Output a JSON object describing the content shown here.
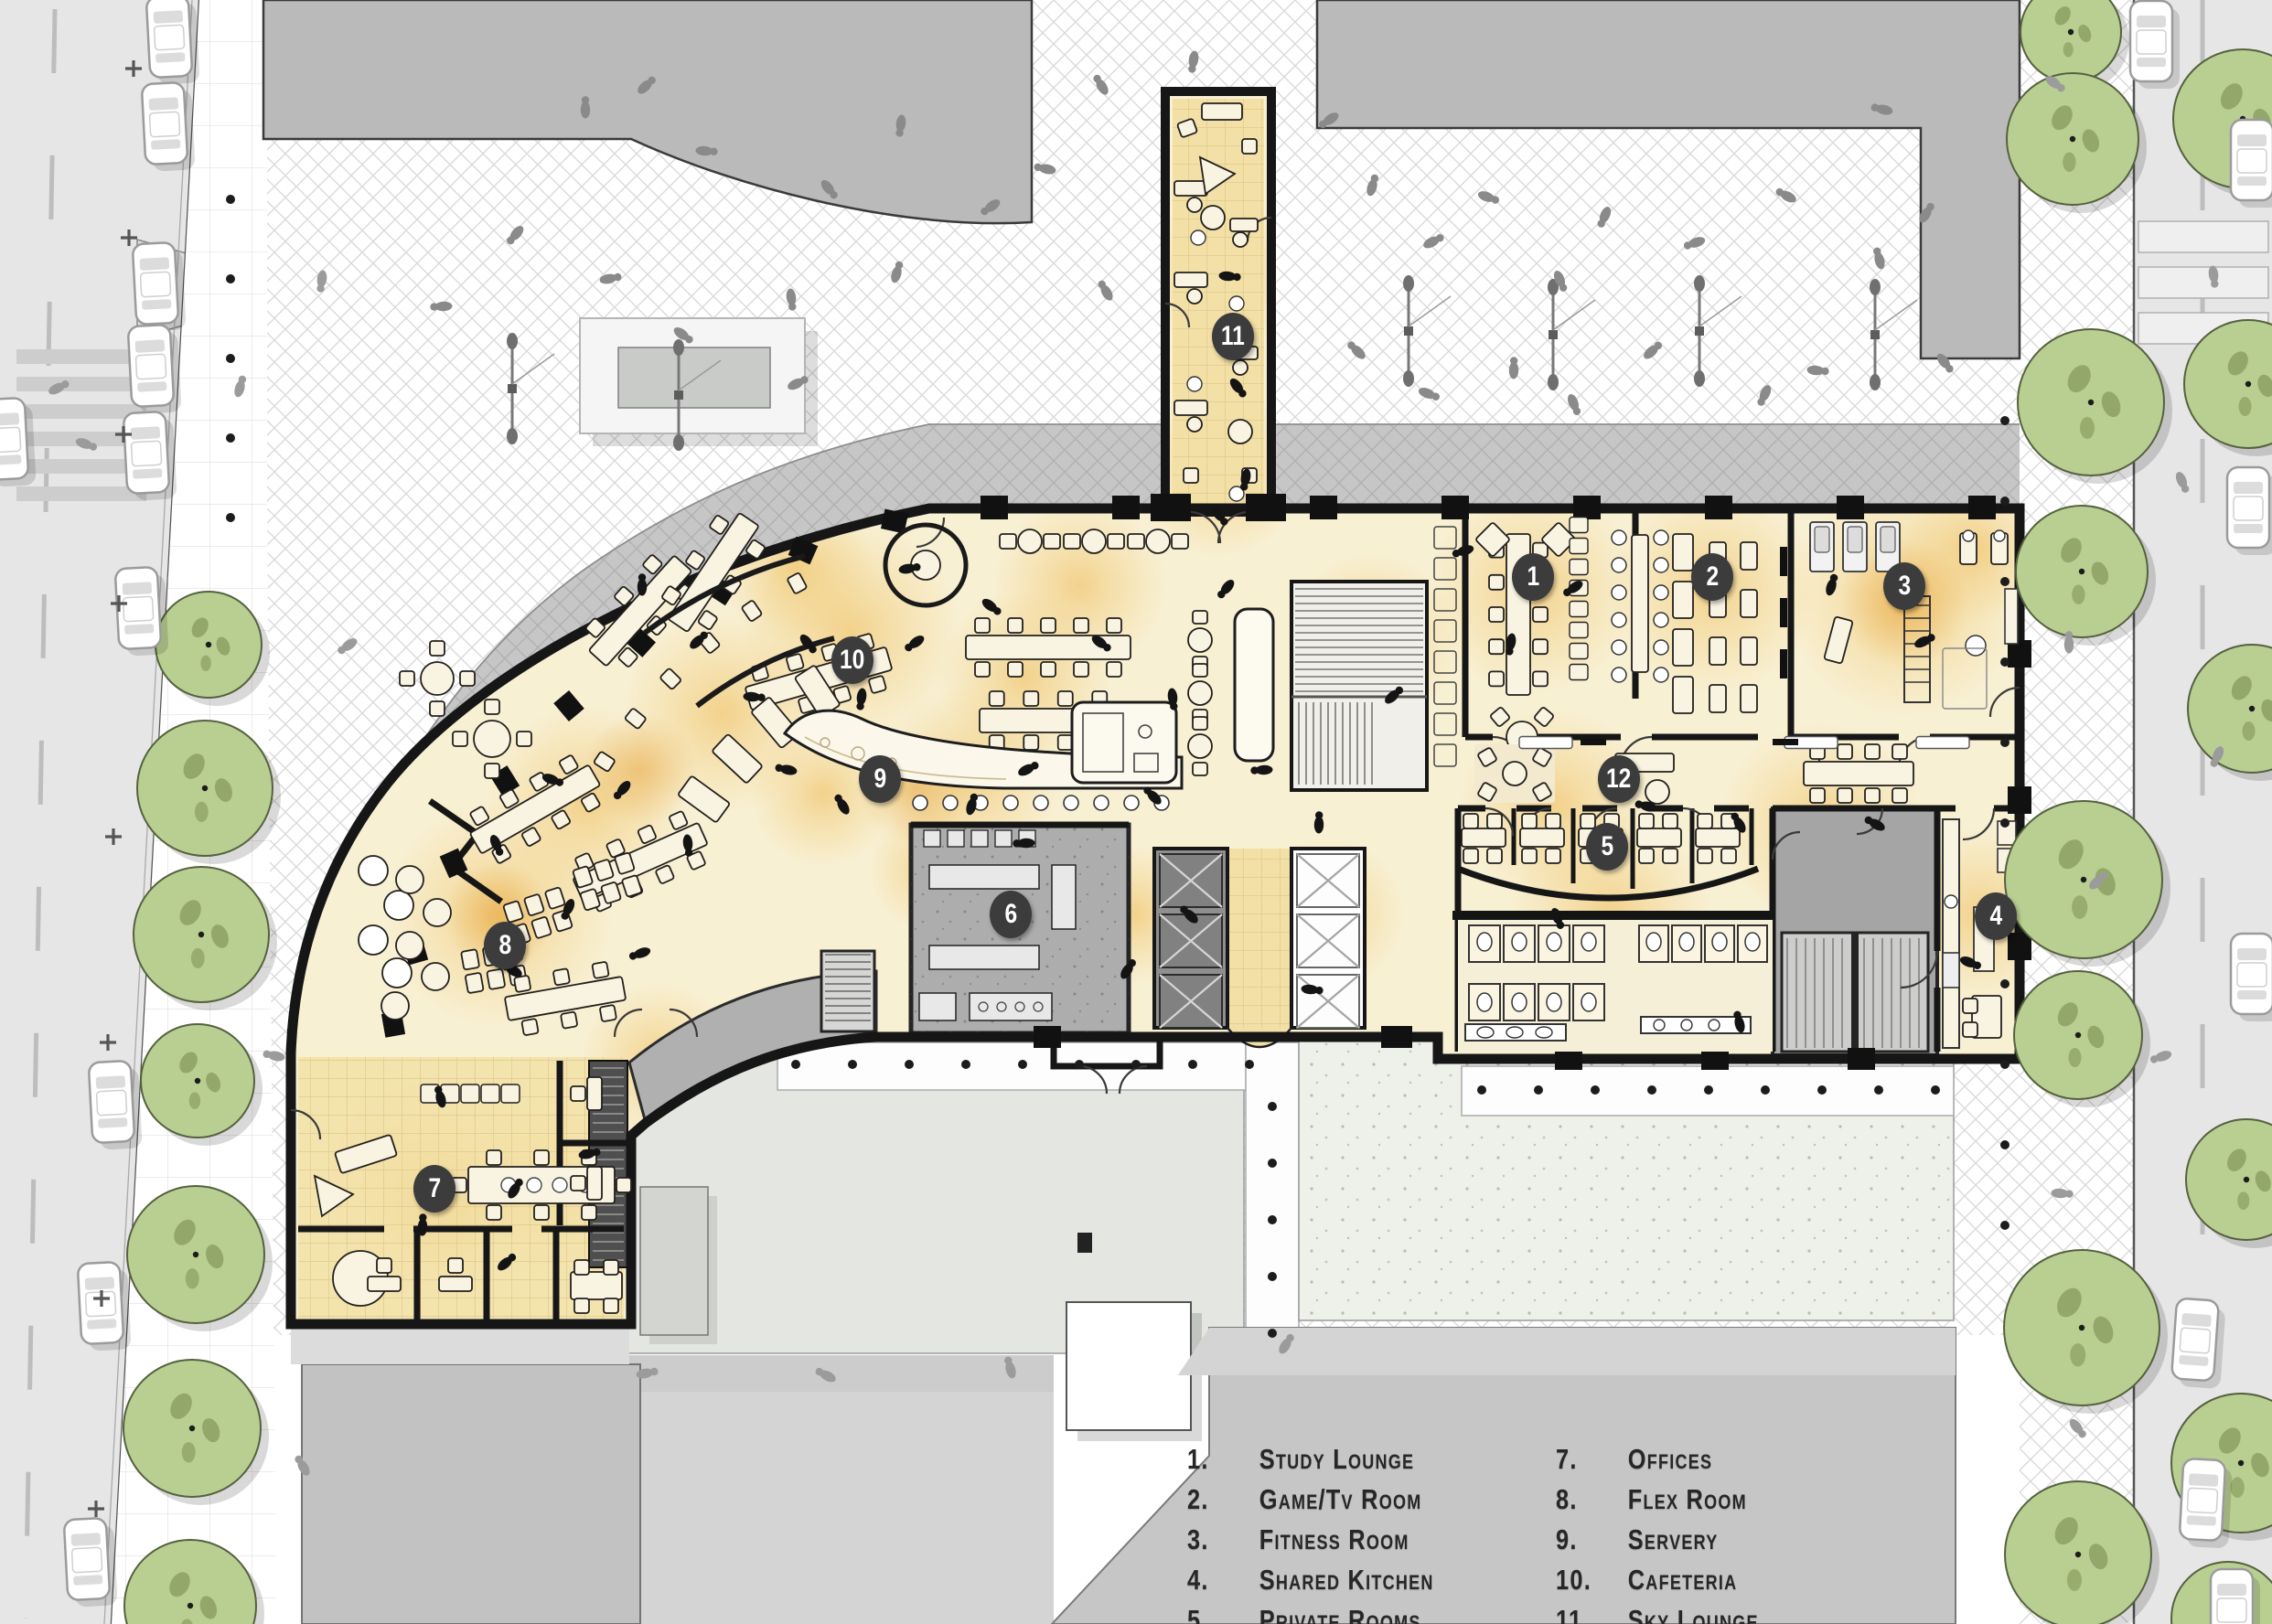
{
  "legend": {
    "items": [
      {
        "id": "1",
        "num": "1.",
        "label": "Study Lounge"
      },
      {
        "id": "2",
        "num": "2.",
        "label": "Game/Tv Room"
      },
      {
        "id": "3",
        "num": "3.",
        "label": "Fitness Room"
      },
      {
        "id": "4",
        "num": "4.",
        "label": "Shared Kitchen"
      },
      {
        "id": "5",
        "num": "5.",
        "label": "Private Rooms"
      },
      {
        "id": "6",
        "num": "6.",
        "label": "Kitchen/Prep"
      },
      {
        "id": "7",
        "num": "7.",
        "label": "Offices"
      },
      {
        "id": "8",
        "num": "8.",
        "label": "Flex Room"
      },
      {
        "id": "9",
        "num": "9.",
        "label": "Servery"
      },
      {
        "id": "10",
        "num": "10.",
        "label": "Cafeteria"
      },
      {
        "id": "11",
        "num": "11.",
        "label": "Sky Lounge"
      },
      {
        "id": "12",
        "num": "12.",
        "label": "Student living Room"
      }
    ]
  },
  "colors": {
    "cream": "#f8f0d3",
    "glow": "#eebb52",
    "tileGold": "#f2e0a6",
    "tileLine": "#d9bf7e",
    "ink": "#161616",
    "ctxGray": "#bababb",
    "paveGray": "#c8c8c8",
    "canopyGray": "#c6c6c6",
    "streetGray": "#e6e6e6",
    "treeFill": "#b9cf92",
    "treeEdge": "#55613f",
    "courtGray": "#e4e7e1",
    "marker": "#3c3c3c",
    "legendText": "#272727",
    "serviceGray": "#aeaeae",
    "furniture": "#f9f3e2"
  }
}
